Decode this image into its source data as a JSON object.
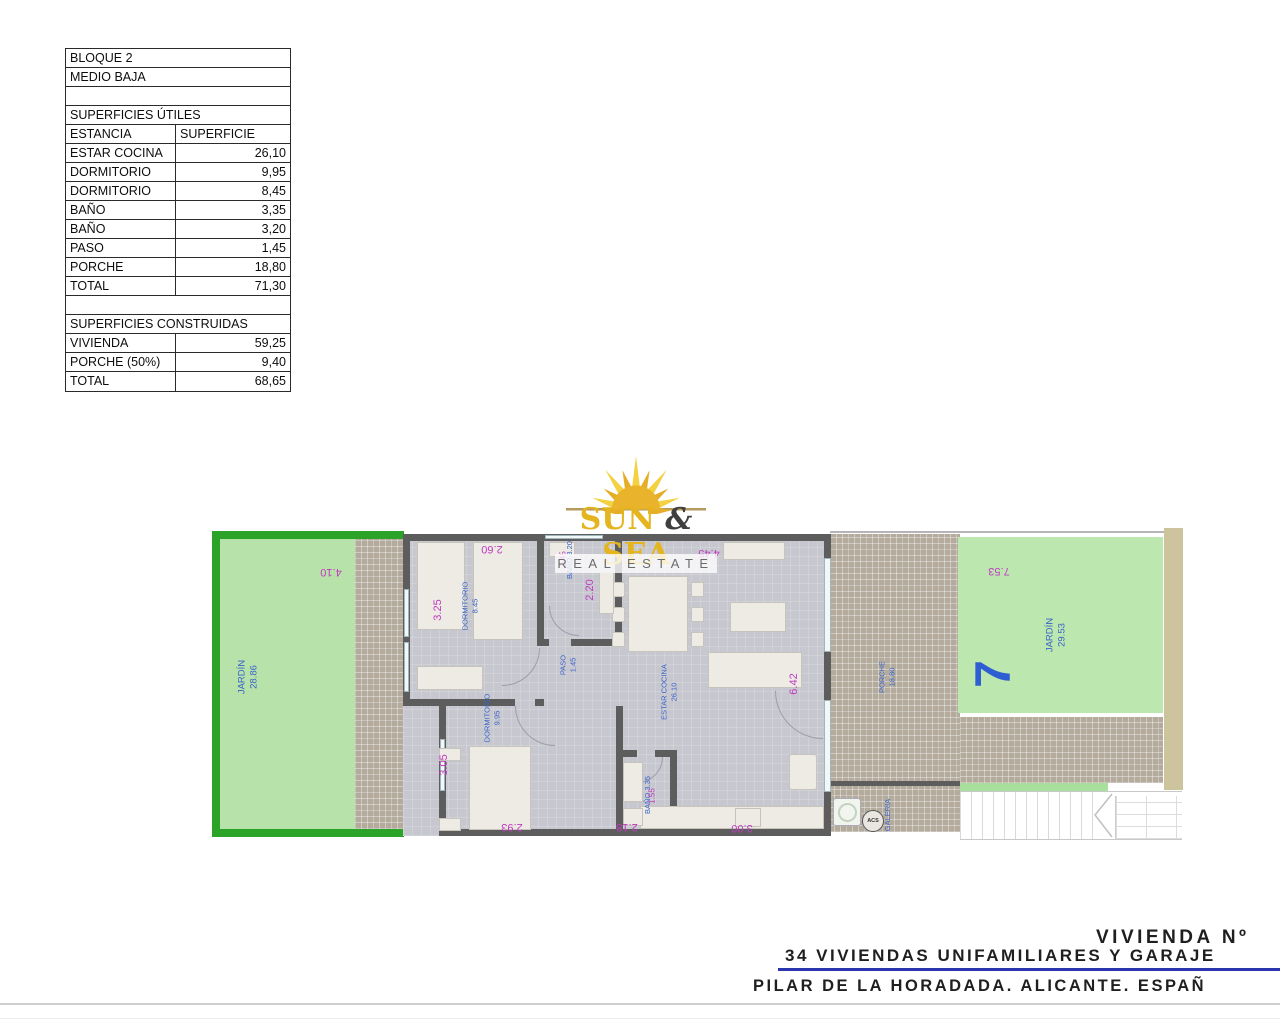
{
  "areas_table": {
    "block": "BLOQUE 2",
    "level": "MEDIO BAJA",
    "useful_title": "SUPERFICIES ÚTILES",
    "col_room": "ESTANCIA",
    "col_area": "SUPERFICIE",
    "useful_rows": [
      {
        "label": "ESTAR COCINA",
        "value": "26,10"
      },
      {
        "label": "DORMITORIO",
        "value": "9,95"
      },
      {
        "label": "DORMITORIO",
        "value": "8,45"
      },
      {
        "label": "BAÑO",
        "value": "3,35"
      },
      {
        "label": "BAÑO",
        "value": "3,20"
      },
      {
        "label": "PASO",
        "value": "1,45"
      },
      {
        "label": "PORCHE",
        "value": "18,80"
      },
      {
        "label": "TOTAL",
        "value": "71,30"
      }
    ],
    "built_title": "SUPERFICIES CONSTRUIDAS",
    "built_rows": [
      {
        "label": "VIVIENDA",
        "value": "59,25"
      },
      {
        "label": "PORCHE (50%)",
        "value": "9,40"
      },
      {
        "label": "TOTAL",
        "value": "68,65"
      }
    ]
  },
  "watermark": {
    "word1": "SUN",
    "amp": "&",
    "word2": "SEA",
    "tagline": "REAL ESTATE"
  },
  "plan": {
    "garden_left": {
      "label": "JARDÍN",
      "area": "28.86",
      "dim_top": "4.10"
    },
    "bedroom1": {
      "label": "DORMITORIO",
      "area": "8.45",
      "dim_top": "2.60",
      "dim_side": "3.25"
    },
    "bath1": {
      "label": "BAÑO 3.20",
      "dim_overlap": "1.45",
      "dim_side": "2.20"
    },
    "paso": {
      "label": "PASO",
      "area": "1.45"
    },
    "bedroom2": {
      "label": "DORMITORIO",
      "area": "9.95",
      "dim_side": "3.05",
      "dim_bottom": "2.93"
    },
    "bath2": {
      "label": "BAÑO 3.35",
      "dim_overlap": "1.55",
      "dim_bottom": "2.18"
    },
    "living": {
      "label": "ESTAR COCINA",
      "area": "26.10",
      "dim_top": "4.45",
      "dim_side": "6.42",
      "dim_bottom": "3.00"
    },
    "porch": {
      "label": "PORCHE",
      "area": "18.80"
    },
    "galeria": {
      "label": "GALERIA",
      "acs": "ACS"
    },
    "garden_right": {
      "label": "JARDÍN",
      "area": "29.53",
      "dim_top": "7.53",
      "plot_number": "7"
    }
  },
  "title_block": {
    "line1": "VIVIENDA Nº",
    "line2": "34 VIVIENDAS UNIFAMILIARES Y GARAJE",
    "line3": "PILAR DE LA HORADADA. ALICANTE. ESPAÑ"
  },
  "colors": {
    "dimension_magenta": "#c23ac2",
    "room_label_blue": "#3a64c8",
    "plot_number_blue": "#2d5fd3",
    "garden_fill": "#b7e3ab",
    "garden_border": "#2ba328",
    "wall_gray": "#5d5d5d",
    "watermark_gold": "#e4b51f",
    "title_line_blue": "#2b35b0"
  }
}
